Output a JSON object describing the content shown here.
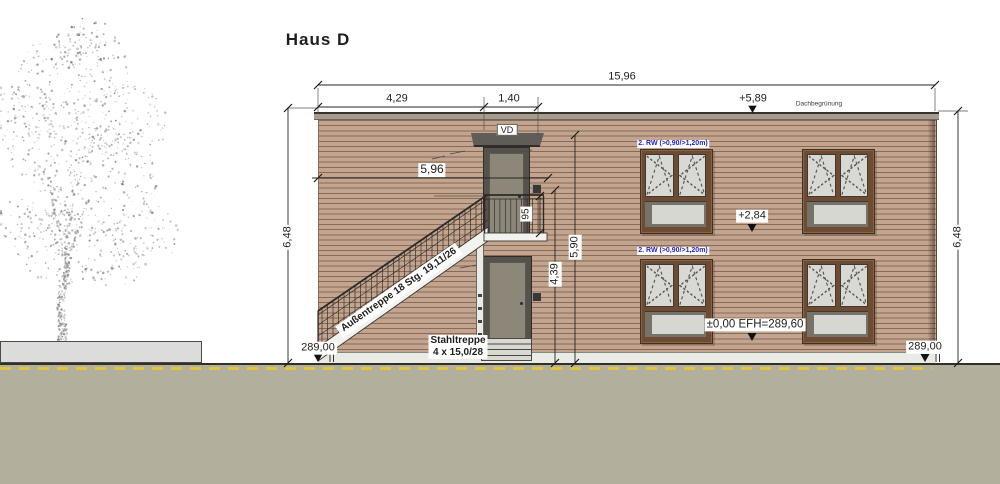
{
  "title": "Haus D",
  "dims": {
    "total": "15,96",
    "stair_run": "4,29",
    "landing": "1,40",
    "entry_width": "5,96",
    "facade_left": "6,48",
    "facade_right": "6,48",
    "railing": "95",
    "door_line": "4,39",
    "upper_line": "5,90"
  },
  "levels": {
    "roof": "+5,89",
    "upper_floor": "+2,84",
    "ground_floor": "±0,00 EFH=289,60",
    "terrain_left": "289,00",
    "terrain_right": "289,00"
  },
  "notes": {
    "roof": "Dachbegrünung",
    "door_top": "VD",
    "rescue_upper": "2. RW (>0,90/>1,20m)",
    "rescue_lower": "2. RW (>0,90/>1,20m)",
    "steel_stair_1": "Stahltreppe",
    "steel_stair_2": "4 x 15,0/28",
    "outdoor_stair": "Außentreppe 18 Stg. 19,11/26"
  },
  "colors": {
    "facade": "#c3a58f",
    "facade_line": "#543b2a",
    "window_frame": "#6e4b31",
    "glass": "#d8d8d4",
    "spandrel_panel": "#d7d7d2",
    "door": "#8c8779",
    "ground": "#b2b09d",
    "road_marking_yellow": "#e2c53e",
    "rescue_label_blue": "#2323c8"
  }
}
